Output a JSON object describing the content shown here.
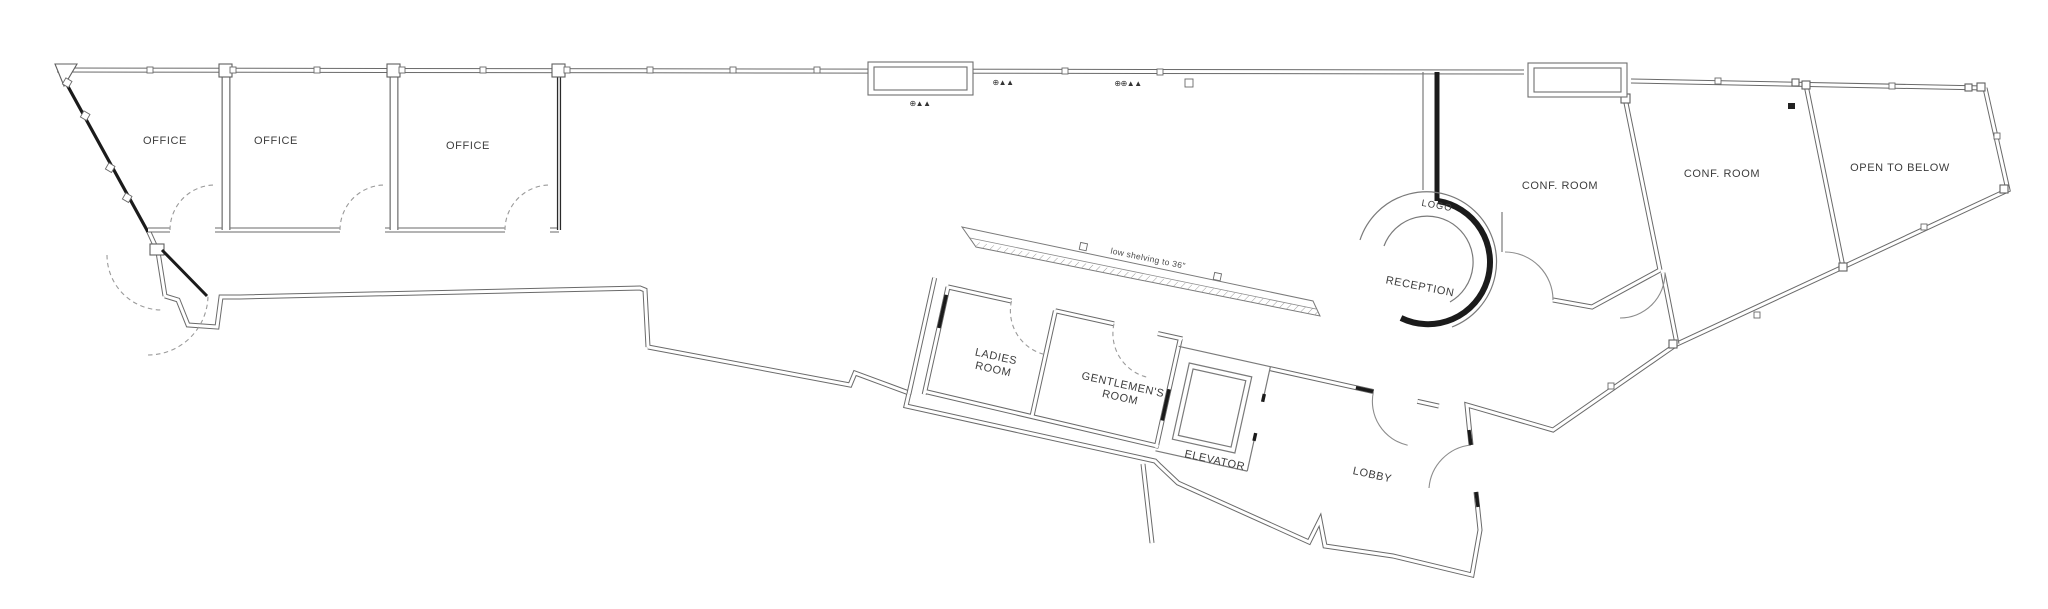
{
  "canvas": {
    "width": 2048,
    "height": 609,
    "background": "#ffffff",
    "wall_color": "#6a6a6a",
    "dark_wall_color": "#1b1b1b",
    "label_color": "#3d3d3d"
  },
  "plan_type": "office-floor-plan",
  "rooms": [
    {
      "name": "office-1",
      "label": "OFFICE"
    },
    {
      "name": "office-2",
      "label": "OFFICE"
    },
    {
      "name": "office-3",
      "label": "OFFICE"
    },
    {
      "name": "conf-room-west",
      "label": "CONF. ROOM"
    },
    {
      "name": "conf-room-east",
      "label": "CONF. ROOM"
    },
    {
      "name": "open-to-below",
      "label": "OPEN TO BELOW"
    },
    {
      "name": "reception",
      "label": "RECEPTION"
    },
    {
      "name": "logo",
      "label": "LOGO"
    },
    {
      "name": "ladies-room",
      "label_line1": "LADIES",
      "label_line2": "ROOM"
    },
    {
      "name": "gentlemens-room",
      "label_line1": "GENTLEMEN'S",
      "label_line2": "ROOM"
    },
    {
      "name": "elevator",
      "label": "ELEVATOR"
    },
    {
      "name": "lobby",
      "label": "LOBBY"
    }
  ],
  "annotations": [
    {
      "name": "low-shelving-note",
      "label": "low shelving to 36\""
    }
  ],
  "fixtures": [
    {
      "name": "wall-fixture-1",
      "glyph": "⊕▲▲"
    },
    {
      "name": "wall-fixture-2",
      "glyph": "⊕▲▲"
    },
    {
      "name": "wall-fixture-3",
      "glyph": "⊕⊕▲▲"
    }
  ]
}
